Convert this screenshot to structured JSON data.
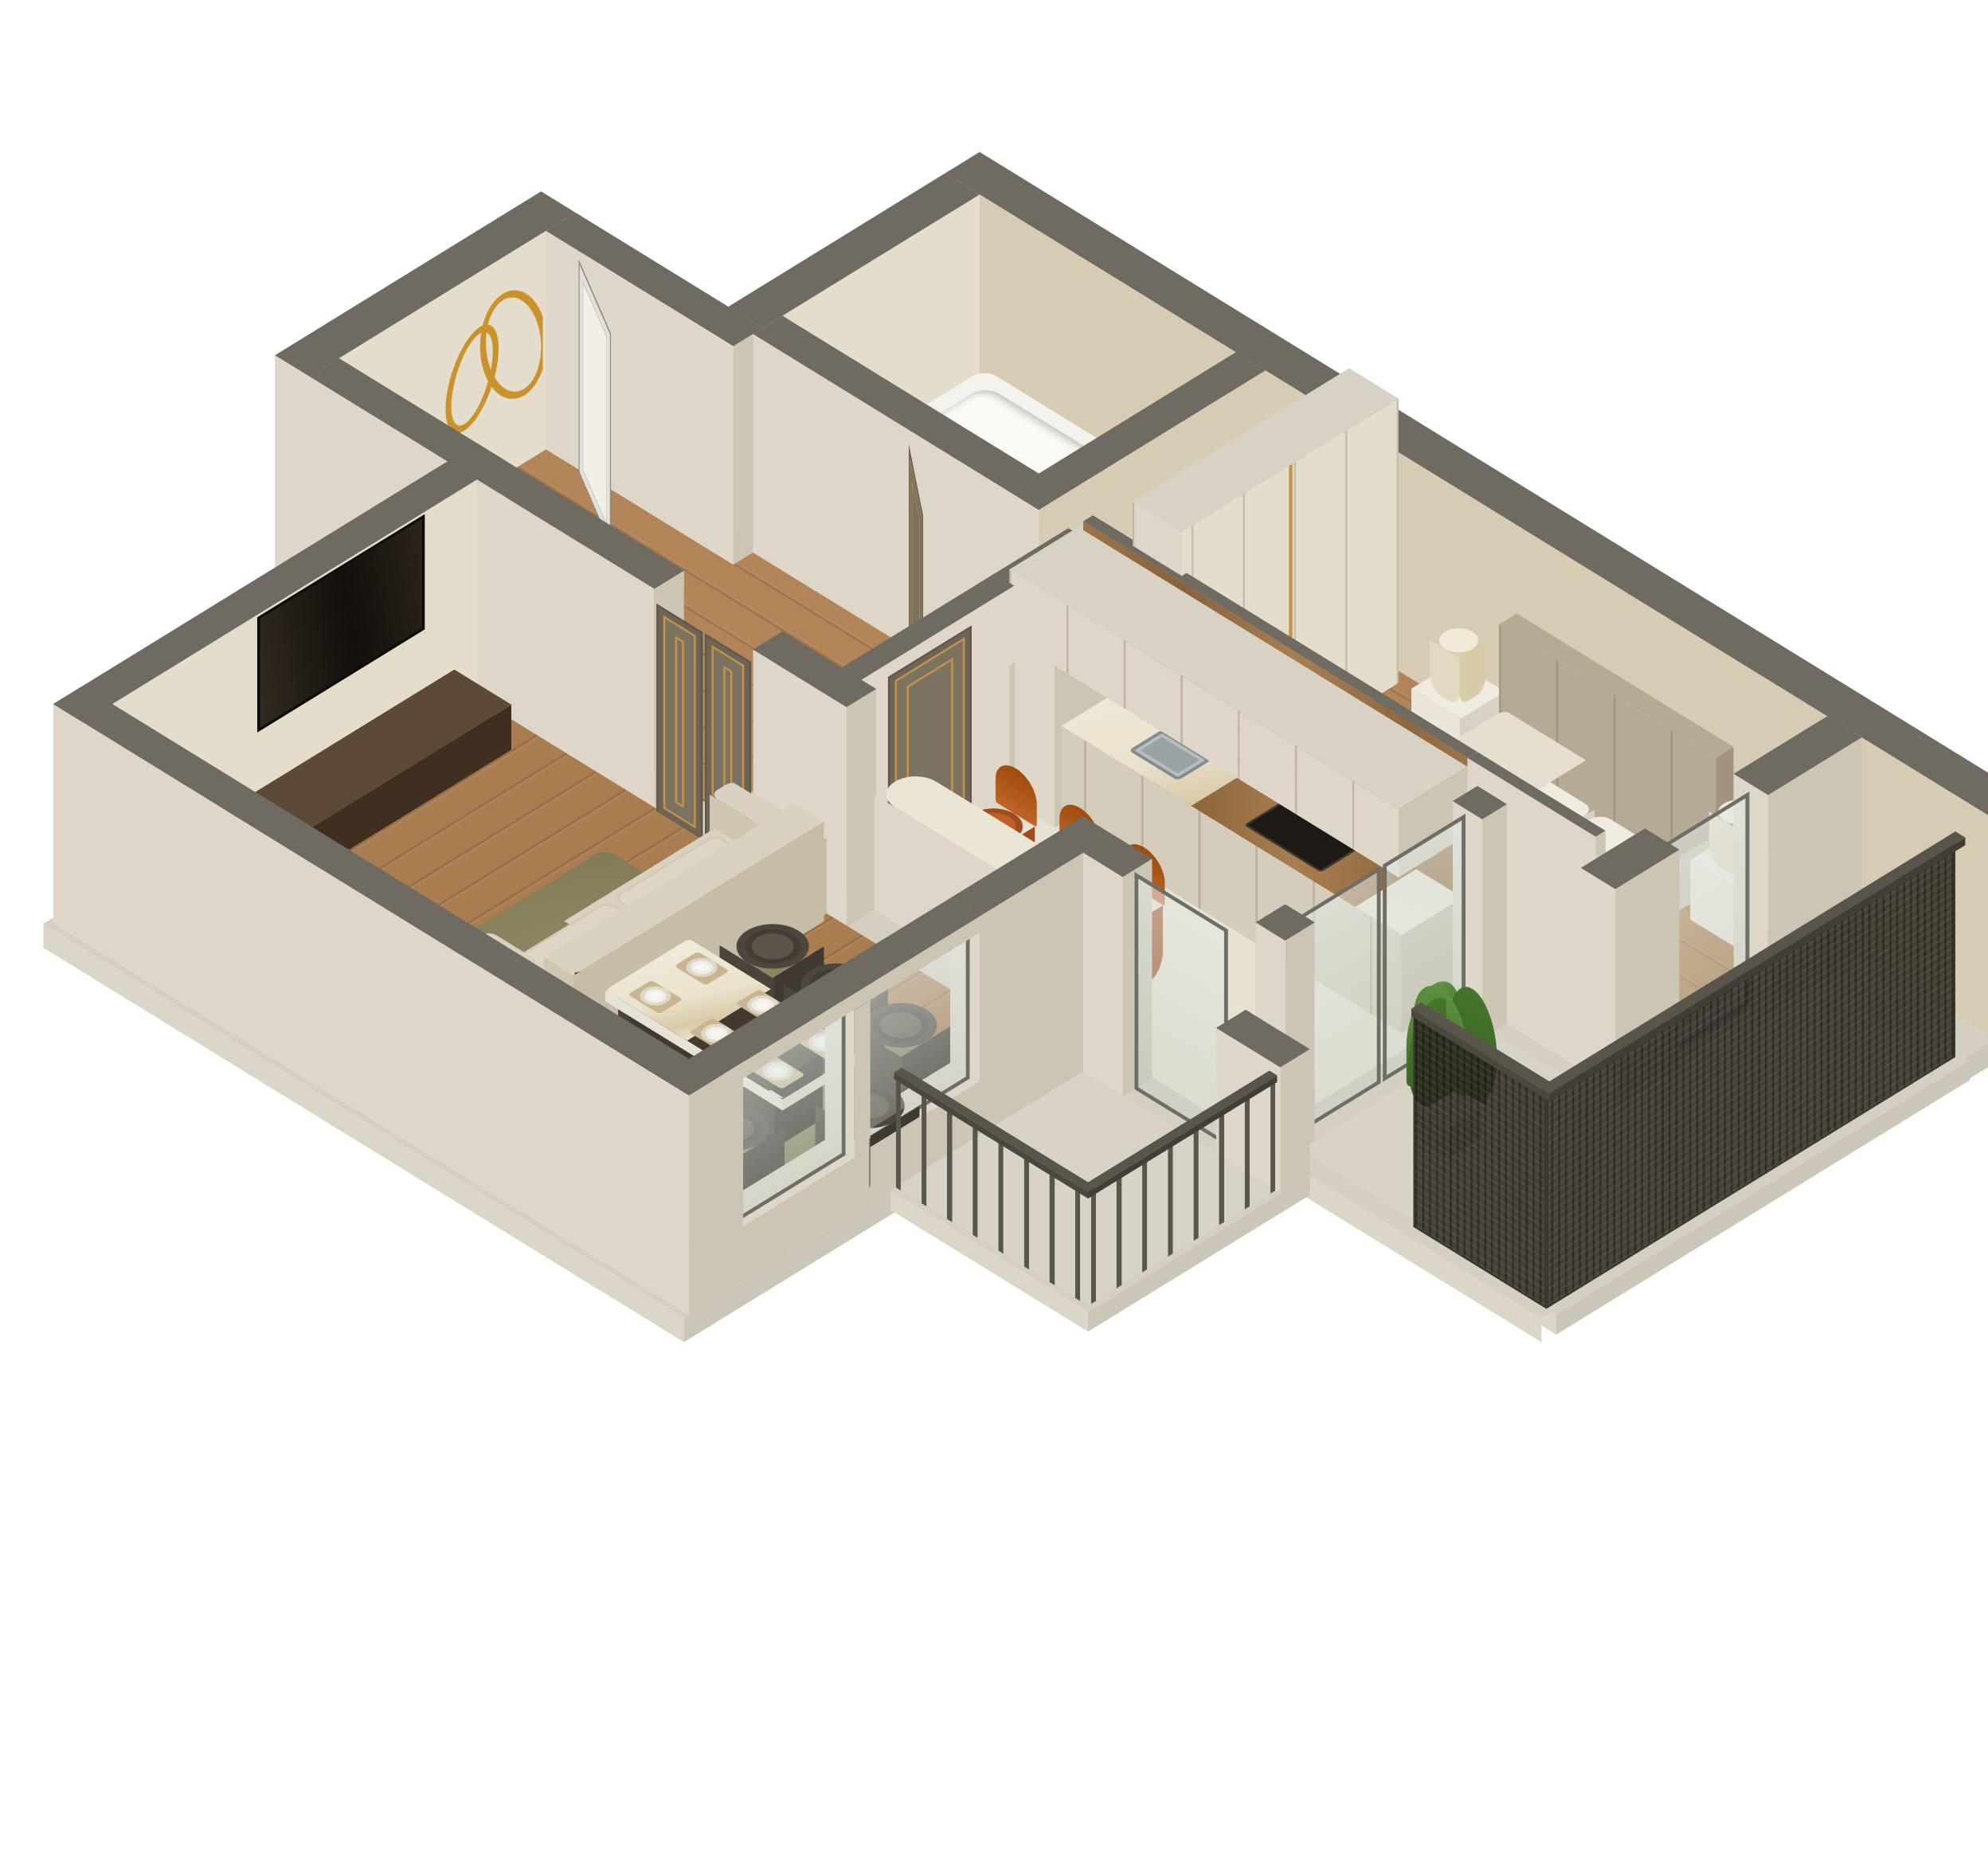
{
  "meta": {
    "title": "3D isometric cutaway floor plan rendering of a one-bedroom apartment",
    "view": "axonometric bird's-eye cutaway, walls sliced with grey tops, white background"
  },
  "colors": {
    "wall_top": "#6f6a62",
    "wall_top_light": "#d8d2c4",
    "wall_cream_lit": "#ded7c9",
    "wall_cream_shade": "#cdc5b4",
    "wall_beige_lit": "#d7cbb3",
    "wall_inner_light": "#e4ddcc",
    "base_plinth_lit": "#dcd6c9",
    "base_plinth_shade": "#ccc6b8",
    "base_plinth_top": "#d5cfc2",
    "wood_floor": "#b28457",
    "wood_floor_living": "#aa7d51",
    "tile_kitchen": "#e7e1d2",
    "tile_bath": "#e1dac8",
    "tile_balcony": "#d8d3c6",
    "door_grey": "#7b7262",
    "door_gold": "#c49347",
    "white_door": "#f1efe8",
    "glass_frame": "#6e6e68",
    "wood_panel": "#9a7145",
    "sofa_cream": "#d9d1c0",
    "sofa_cream_shade": "#c7bca8",
    "orange": "#c05f27",
    "orange_dark": "#9e4c1d",
    "media_brown": "#53402e",
    "tv_black": "#211b15",
    "chair_top": "#5d554a",
    "chair_side": "#4b443b",
    "table_white": "#f1ede3",
    "table_base": "#43392f",
    "rug_olive": "#8e8862",
    "bed_headboard": "#b6a996",
    "mattress": "#e6dfd0",
    "pillow_white": "#f0ebe0",
    "nightstand": "#ece6da",
    "lamp_shade": "#f2ead8",
    "plant_green": "#5f9140",
    "plant_green_dark": "#47752c",
    "mesh_dark": "rgba(44,39,32,0.85)",
    "railing_grey": "#5a554c",
    "gold_art": "#c9922a",
    "tub_white": "#f4f2ec",
    "vanity_brown": "#5c4936",
    "sink_grey": "#9aa2a6",
    "cooktop_black": "#1d1a16"
  },
  "rooms": [
    {
      "id": "living-room",
      "label": "Living / dining room",
      "floor": "wood planks"
    },
    {
      "id": "kitchen",
      "label": "Kitchen",
      "floor": "light stone tile"
    },
    {
      "id": "bedroom",
      "label": "Bedroom",
      "floor": "wood planks"
    },
    {
      "id": "bathroom",
      "label": "Bathroom",
      "floor": "mosaic tile"
    },
    {
      "id": "hallway",
      "label": "Hallway",
      "floor": "wood planks"
    },
    {
      "id": "entry",
      "label": "Entry nook",
      "floor": "wood planks"
    },
    {
      "id": "balcony-right",
      "label": "Balcony at bedroom",
      "floor": "stone tile"
    },
    {
      "id": "balcony-bottom",
      "label": "Balcony at living room",
      "floor": "stone tile"
    }
  ],
  "furniture": {
    "living_room": [
      "wall-mounted TV",
      "dark wood media console",
      "cream tufted sofa with 2 orange pillows",
      "olive area rug",
      "white marble dining table on dark base",
      "8 dark taupe tub chairs",
      "6 place settings with placemats",
      "2 framed windows"
    ],
    "kitchen": [
      "cream cabinet run with marble counter",
      "undermount sink with black faucet",
      "black cooktop",
      "wood panel backsplash wall",
      "suspended cream cabinet bridge",
      "bar-height counter wall",
      "3 burnt-orange bar stools",
      "sliding glass doors to balconies"
    ],
    "bedroom": [
      "upholstered bed with tall headboard",
      "2 white pillows",
      "3 orange accent pillows",
      "2 white nightstands",
      "2 cream table lamps",
      "dark rug at bed foot",
      "tall cream wardrobe wall with gold handles",
      "glass door to balcony"
    ],
    "bathroom": [
      "white bathtub",
      "dark wood vanity with sink"
    ],
    "hallway": [
      "grey doors with gold trim"
    ],
    "entry": [
      "white entry door standing open",
      "gold abstract wire wall art"
    ],
    "balcony_right": [
      "full-height dark mesh railing",
      "green potted plant"
    ],
    "balcony_bottom": [
      "grey metal bar railing"
    ]
  },
  "counts": {
    "grey_gold_doors": 4,
    "white_entry_door": 1,
    "glass_panels": 6,
    "dining_chairs": 8,
    "bar_stools": 3,
    "orange_bed_pillows": 3,
    "windows": 2
  }
}
